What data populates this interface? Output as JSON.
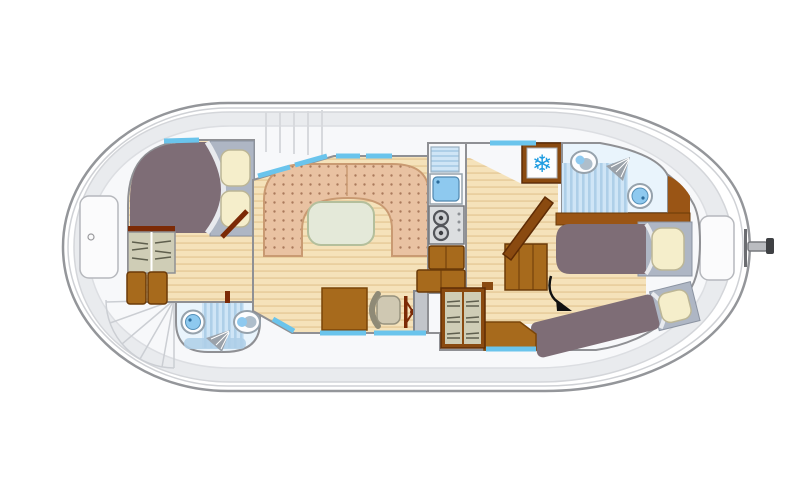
{
  "diagram": {
    "type": "boat-deck-floorplan",
    "vessel": "canal-cruiser-penichette",
    "rooms": [
      {
        "id": "bow-cabin",
        "features": [
          "double-bed",
          "wardrobe",
          "cabinets",
          "door",
          "window"
        ]
      },
      {
        "id": "bow-bathroom",
        "features": [
          "washbasin",
          "shower",
          "toilet"
        ]
      },
      {
        "id": "saloon",
        "features": [
          "u-shaped-settee",
          "table",
          "windows"
        ]
      },
      {
        "id": "helm-station",
        "features": [
          "swivel-chair",
          "steering-wheel",
          "console",
          "cabinet",
          "wardrobe"
        ]
      },
      {
        "id": "galley",
        "features": [
          "draining-board",
          "sink",
          "two-burner-stove",
          "cabinets",
          "refrigerator"
        ]
      },
      {
        "id": "stern-bathroom",
        "features": [
          "toilet",
          "shower",
          "washbasin"
        ]
      },
      {
        "id": "stern-cabin",
        "features": [
          "single-bed",
          "single-bed-angled",
          "corner-seat",
          "door",
          "arrow-marker"
        ]
      }
    ],
    "deck_features": [
      "bow-hatch",
      "stern-hatch",
      "spiral-steps",
      "side-steps",
      "tiller-rudder"
    ]
  },
  "icons": {
    "snowflake": "❄"
  },
  "colors": {
    "hull_stroke": "#94969a",
    "hull_inner_line": "#cfd1d5",
    "deck_fill": "#e9ebee",
    "deck_inner_fill": "#f7f8fa",
    "wall_fill": "#f7f8fa",
    "wall_stroke": "#8f9094",
    "wood_light": "#f5e2ba",
    "wood_dark": "#e9cf9f",
    "settee_base": "#e9c2a2",
    "settee_dot": "#aa7a5c",
    "settee_stroke": "#c99a72",
    "table_fill": "#e4e9d9",
    "table_stroke": "#b4bf9c",
    "blanket_mauve": "#7e6d76",
    "mattress_gray": "#aeb6c4",
    "pillow_cream": "#f5eecb",
    "sheet_white": "#e8eaee",
    "furniture_brown": "#a76a1c",
    "furniture_brown_dark": "#7a4508",
    "frame_brown": "#8a4a10",
    "frame_brown_dark": "#5f2c05",
    "door_red_brown": "#7c2a06",
    "headboard_brown": "#9a5515",
    "cabinet_khaki": "#cfcdb6",
    "shelf_line": "#5f5f4e",
    "window_blue": "#6ac4ec",
    "bath_floor": "#e9f4fc",
    "shower_stripe_a": "#cfe5f6",
    "shower_stripe_b": "#aecfe8",
    "water_blue": "#8ec9ef",
    "fixture_white": "#fdfdfe",
    "fixture_stroke": "#96a2ac",
    "console_gray": "#c2c5ca",
    "chair_beige": "#cfc8b2",
    "stove_gray": "#dcdee0",
    "burner_dark": "#53555a",
    "snowflake_blue": "#1e9ce0",
    "stair_line": "#cbced3",
    "step_line": "#d7d9dd",
    "arrow_black": "#111111"
  }
}
